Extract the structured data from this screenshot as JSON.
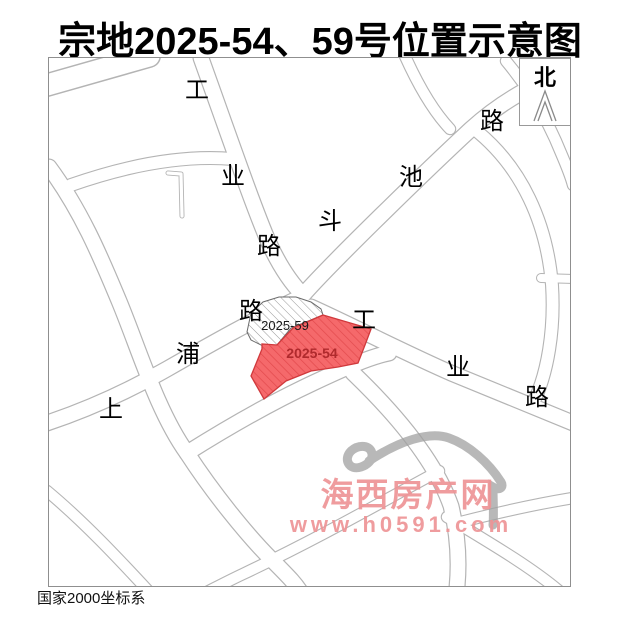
{
  "title": "宗地2025-54、59号位置示意图",
  "north": {
    "label": "北"
  },
  "coordinate_note": "国家2000坐标系",
  "parcels": {
    "p59": {
      "label": "2025-59",
      "style": "white-diagonal-hatch"
    },
    "p54": {
      "label": "2025-54",
      "style": "red-diagonal-hatch",
      "fill": "#f5696b",
      "hatch": "#e34a4d",
      "label_color": "#b02a2d"
    }
  },
  "road_labels": {
    "gongye_north": {
      "name": "工业路",
      "chars": [
        "工",
        "业",
        "路"
      ]
    },
    "douchi": {
      "name": "斗池路",
      "chars": [
        "斗",
        "池",
        "路"
      ]
    },
    "shangpu": {
      "name": "上浦路",
      "chars": [
        "上",
        "浦",
        "路"
      ]
    },
    "gongye_east": {
      "name": "工业路",
      "chars": [
        "工",
        "业",
        "路"
      ]
    }
  },
  "watermark": {
    "site_name": "海西房产网",
    "site_url": "www.h0591.com",
    "text_color": "#ee9496"
  },
  "colors": {
    "road_line": "#b4b4b4",
    "frame": "#8f8f8f",
    "parcel54_fill": "#f5696b",
    "parcel54_label": "#b02a2d",
    "title": "#000000"
  }
}
